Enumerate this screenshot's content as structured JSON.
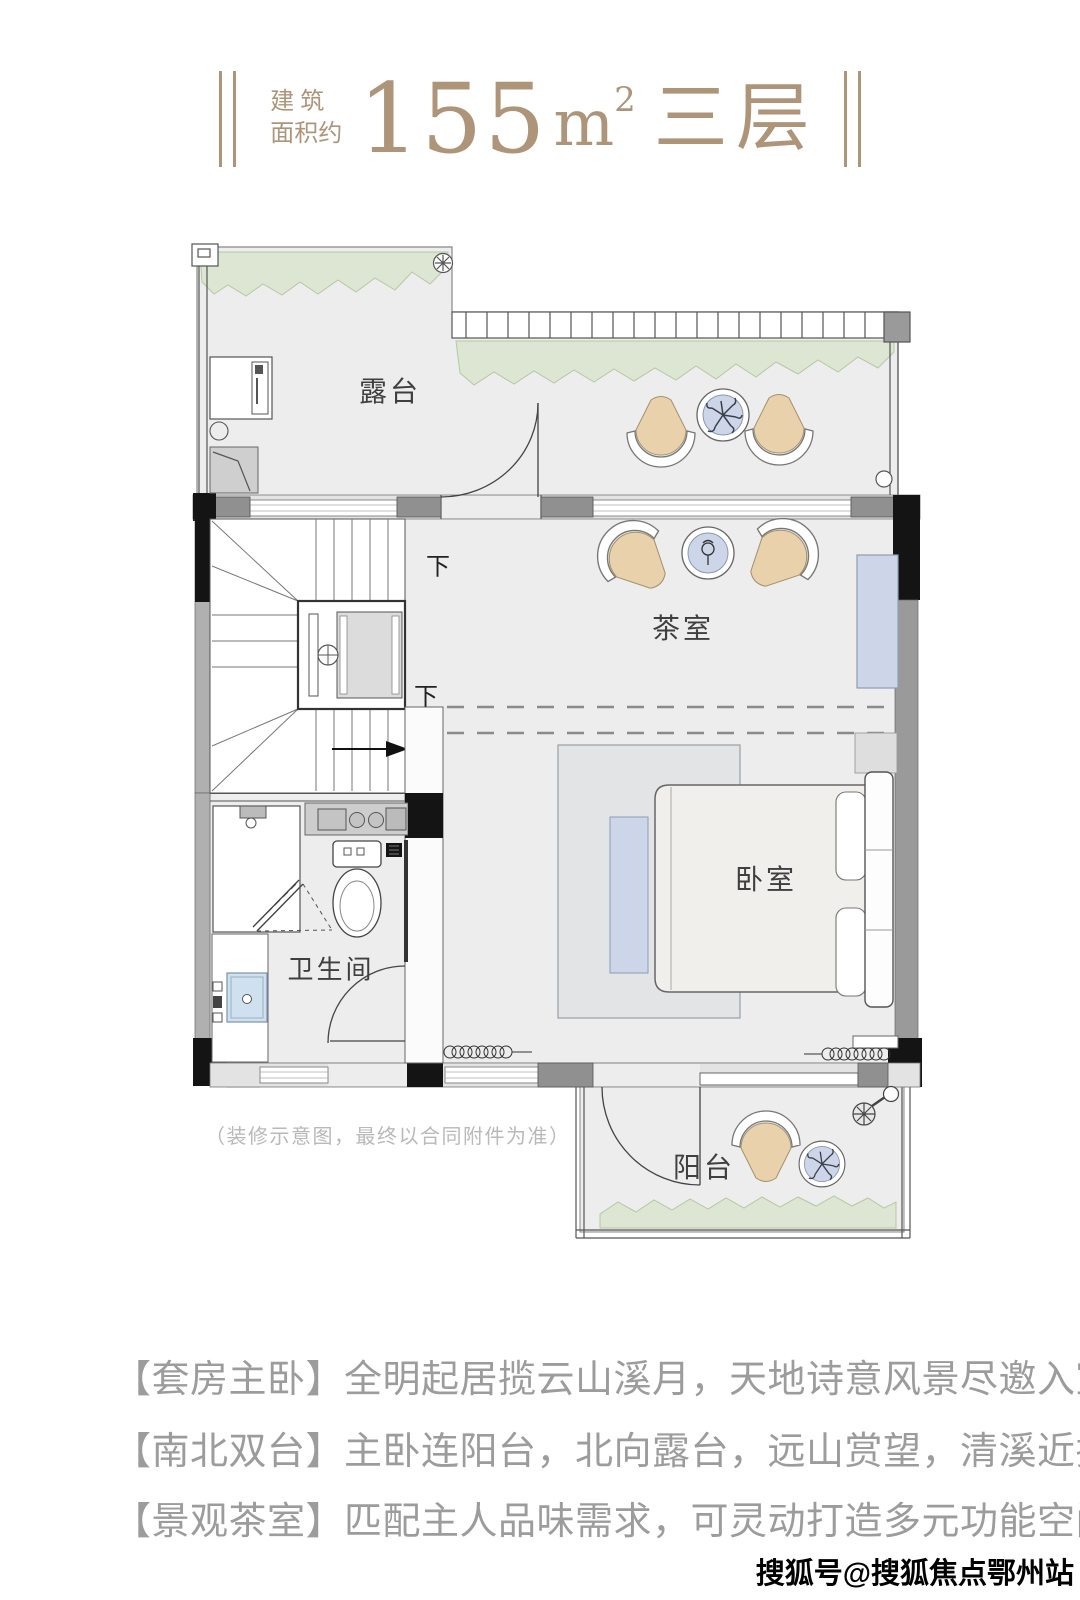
{
  "header": {
    "area_prefix_line1": "建 筑",
    "area_prefix_line2": "面积约",
    "area_number": "155",
    "area_unit_letter": "m",
    "area_unit_sup": "2",
    "floor_label": "三层"
  },
  "plan": {
    "room_labels": {
      "terrace": "露台",
      "tea_room": "茶室",
      "bedroom": "卧室",
      "bathroom": "卫生间",
      "balcony": "阳台"
    },
    "stair_labels": {
      "down_upper": "下",
      "down_lower": "下"
    },
    "disclaimer": "（装修示意图，最终以合同附件为准）"
  },
  "features": [
    {
      "tag": "【套房主卧】",
      "desc": "全明起居揽云山溪月，天地诗意风景尽邀入室"
    },
    {
      "tag": "【南北双台】",
      "desc": "主卧连阳台，北向露台，远山赏望，清溪近揽"
    },
    {
      "tag": "【景观茶室】",
      "desc": "匹配主人品味需求，可灵动打造多元功能空间"
    }
  ],
  "watermark": "搜狐号@搜狐焦点鄂州站",
  "colors": {
    "accent": "#ae9579",
    "floor": "#ededed",
    "greenery": "#dde6d2",
    "furniture_tan": "#e9d2ab",
    "furniture_blue": "#ccd6e8",
    "text_gray": "#9c9c9c"
  }
}
